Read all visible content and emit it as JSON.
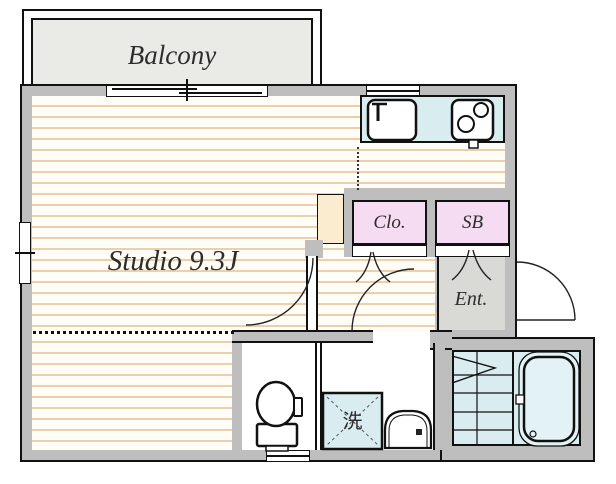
{
  "colors": {
    "wall-gray": "#bebebe",
    "balcony-fill": "#eaeae7",
    "floor-base": "#fffdf6",
    "floor-stripe": "#ecd0ae",
    "water-blue": "#d9edf1",
    "tub-blue": "#e3f2f5",
    "closet-pink": "#f6dcf2",
    "cream": "#fbecd0",
    "entry-gray": "#d9d9d6"
  },
  "rooms": {
    "balcony": {
      "label": "Balcony"
    },
    "studio": {
      "label": "Studio 9.3J"
    },
    "closet": {
      "label": "Clo."
    },
    "shoe_box": {
      "label": "SB"
    },
    "entrance": {
      "label": "Ent."
    },
    "laundry_pan": {
      "label": "洗"
    }
  },
  "fixtures": {
    "sink": "kitchen-sink",
    "stove": "two-burner-stove",
    "toilet": "toilet",
    "washer": "washing-machine-pan",
    "vanity": "wash-basin",
    "tub": "bathtub"
  }
}
